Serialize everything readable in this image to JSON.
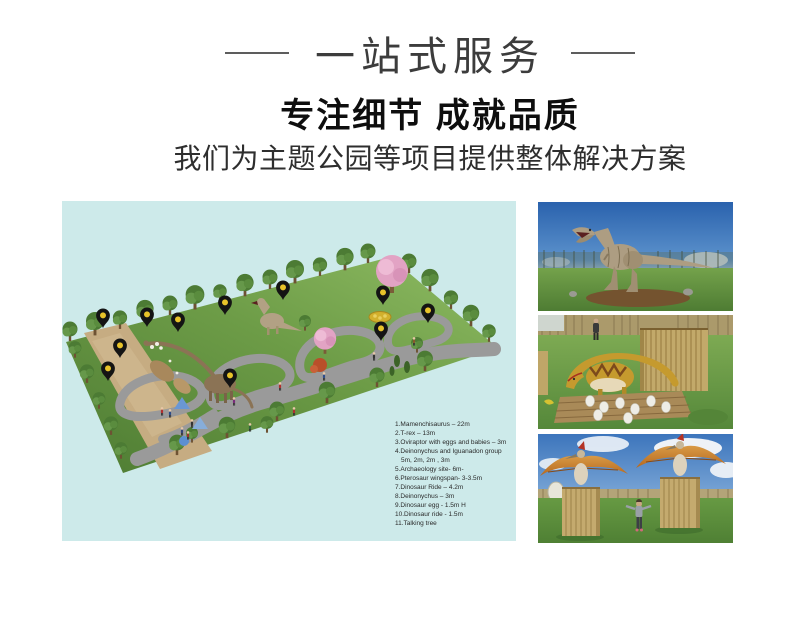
{
  "header": {
    "title": "一站式服务",
    "heading": "专注细节 成就品质",
    "subheading": "我们为主题公园等项目提供整体解决方案"
  },
  "park": {
    "background_color": "#cdeaea",
    "pin_count": 11,
    "pin_color": "#141414",
    "pin_dot_color": "#e8c32a",
    "legend": {
      "lines": [
        "1.Mamenchisaurus – 22m",
        "2.T-rex – 13m",
        "3.Oviraptor with eggs and babies – 3m",
        "4.Deinonychus and Iguanadon group",
        "5m, 2m, 2m , 3m",
        "5.Archaeology site- 6m-",
        "6.Pterosaur  wingspan- 3-3.5m",
        "7.Dinosaur Ride – 4.2m",
        "8.Deinonychus – 3m",
        "9.Dinosaur egg - 1.5m H",
        "10.Dinosaur ride -  1.5m",
        "11.Talking tree"
      ]
    }
  },
  "photos": [
    {
      "name": "t-rex-model-photo"
    },
    {
      "name": "raptor-with-eggs-photo"
    },
    {
      "name": "pterosaur-models-photo"
    }
  ]
}
